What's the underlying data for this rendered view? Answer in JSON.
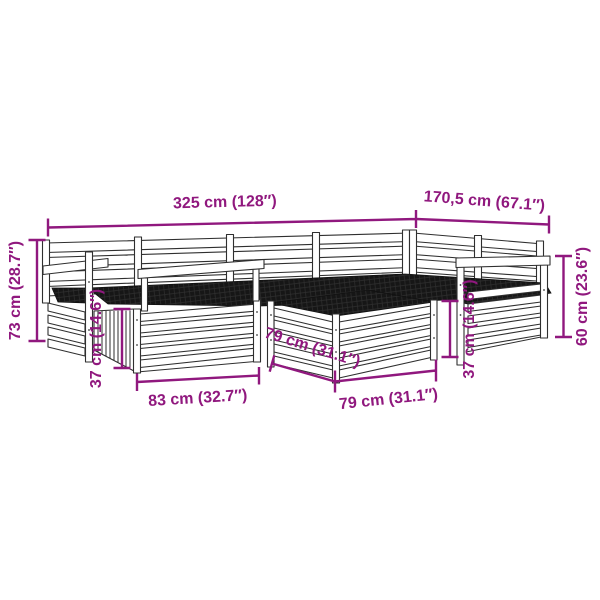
{
  "image": {
    "background": "#ffffff",
    "accent_color": "#90187E",
    "line_color": "#2f2f2f",
    "cushion_color": "#161616",
    "subject": "wooden garden lounge furniture set line drawing with dimension annotations"
  },
  "dimensions": {
    "back_width_left": {
      "label": "325 cm (128″)"
    },
    "back_width_right": {
      "label": "170,5 cm (67.1″)"
    },
    "total_height_left": {
      "label": "73 cm (28.7″)"
    },
    "base_height_left": {
      "label": "37 cm (14.6″)"
    },
    "seat_width_front": {
      "label": "83 cm (32.7″)"
    },
    "table_depth": {
      "label": "79 cm (31.1″)"
    },
    "table_width": {
      "label": "79 cm (31.1″)"
    },
    "table_height": {
      "label": "37 cm (14.6″)"
    },
    "right_height": {
      "label": "60 cm (23.6″)"
    }
  }
}
